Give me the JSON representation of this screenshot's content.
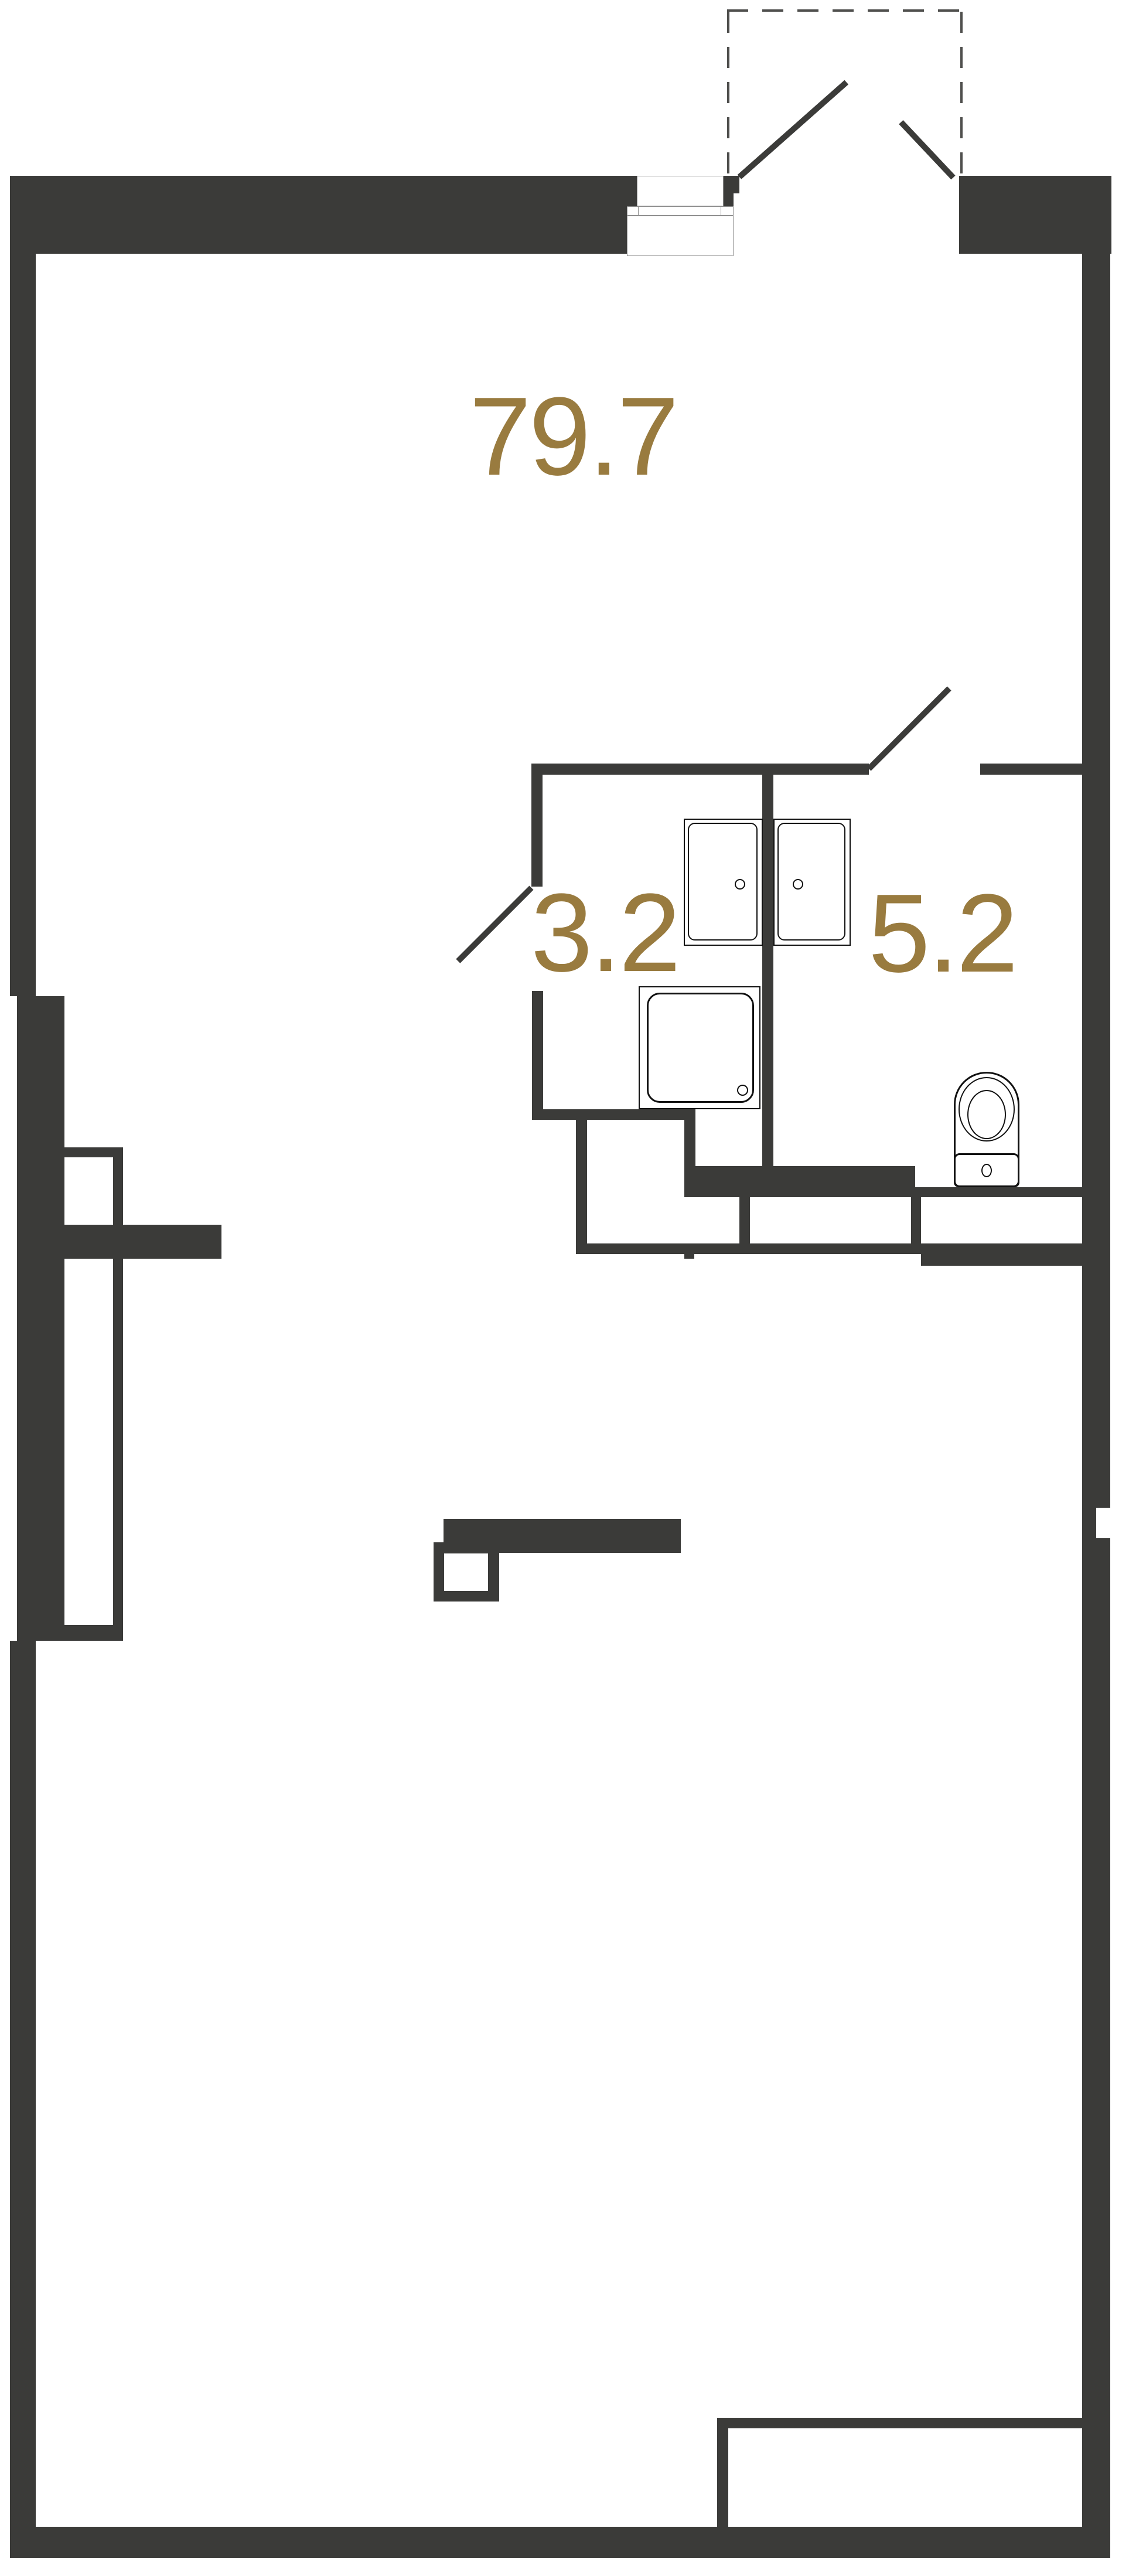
{
  "plan": {
    "rooms": [
      {
        "name": "main-room",
        "area": "79.7"
      },
      {
        "name": "shower-room",
        "area": "3.2"
      },
      {
        "name": "bathroom",
        "area": "5.2"
      }
    ],
    "fixtures": [
      {
        "name": "sink-left"
      },
      {
        "name": "sink-right"
      },
      {
        "name": "shower-tray"
      },
      {
        "name": "toilet"
      }
    ],
    "colors": {
      "wall": "#3b3b39",
      "label": "#997b3f",
      "fixture_line": "#111111",
      "frame_line": "#8f8f8f",
      "dashed_line": "#4f4f4d",
      "background": "#ffffff"
    }
  }
}
